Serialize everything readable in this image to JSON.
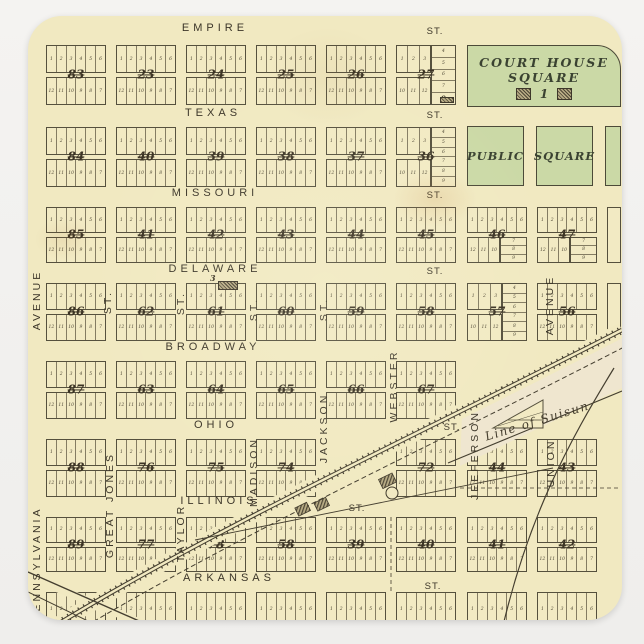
{
  "page": {
    "background": "#f1f0ee"
  },
  "map": {
    "paper_color": "#f1e9c1",
    "ink_color": "#4b4334",
    "square_green": "#cbd9a6",
    "beyond_line_color": "#efe6cf"
  },
  "streets": {
    "horizontal": [
      {
        "name": "EMPIRE",
        "st": "ST."
      },
      {
        "name": "TEXAS",
        "st": "ST."
      },
      {
        "name": "MISSOURI",
        "st": "ST."
      },
      {
        "name": "DELAWARE",
        "st": "ST."
      },
      {
        "name": "BROADWAY",
        "st": ""
      },
      {
        "name": "OHIO",
        "st": "ST."
      },
      {
        "name": "ILLINOIS",
        "st": "ST."
      },
      {
        "name": "ARKANSAS",
        "st": "ST."
      }
    ],
    "vertical": [
      {
        "name": "PENNSYLVANIA"
      },
      {
        "name": "AVENUE"
      },
      {
        "name": "ST."
      },
      {
        "name": "GREAT JONES"
      },
      {
        "name": "ST."
      },
      {
        "name": "TAYLOR"
      },
      {
        "name": "ST."
      },
      {
        "name": "MADISON"
      },
      {
        "name": "ST."
      },
      {
        "name": "JACKSON"
      },
      {
        "name": "WEBSTER"
      },
      {
        "name": "JEEFERSON"
      },
      {
        "name": "AVENUE"
      },
      {
        "name": "UNION"
      }
    ]
  },
  "landmarks": {
    "court_house_square": {
      "line1": "COURT HOUSE",
      "line2": "SQUARE",
      "label": "1"
    },
    "public_square": {
      "left": "PUBLIC",
      "right": "SQUARE"
    },
    "boundary_label": "Line of Suisun",
    "block61_label": "3",
    "block27_label": "9"
  },
  "lots": {
    "top": [
      "1",
      "2",
      "3",
      "4",
      "5",
      "6"
    ],
    "bottom": [
      "12",
      "11",
      "10",
      "9",
      "8",
      "7"
    ],
    "left_top": [
      "1",
      "2",
      "3"
    ],
    "left_bottom": [
      "10",
      "11",
      "12"
    ],
    "stack": [
      "4",
      "5",
      "6",
      "7",
      "8",
      "9"
    ],
    "stack9": [
      "4",
      "5",
      "6",
      "7",
      "9"
    ],
    "br_left": [
      "12",
      "11",
      "10"
    ],
    "br_stack": [
      "7",
      "8",
      "9"
    ],
    "tri": [
      "7",
      "8",
      "9"
    ]
  },
  "blocks": {
    "rows": [
      [
        {
          "c": 0,
          "n": "83"
        },
        {
          "c": 1,
          "n": "23"
        },
        {
          "c": 2,
          "n": "24"
        },
        {
          "c": 3,
          "n": "25"
        },
        {
          "c": 4,
          "n": "26"
        },
        {
          "c": 5,
          "n": "27",
          "v": "stack9"
        }
      ],
      [
        {
          "c": 0,
          "n": "84"
        },
        {
          "c": 1,
          "n": "40"
        },
        {
          "c": 2,
          "n": "39"
        },
        {
          "c": 3,
          "n": "38"
        },
        {
          "c": 4,
          "n": "37"
        },
        {
          "c": 5,
          "n": "36",
          "v": "stack"
        }
      ],
      [
        {
          "c": 0,
          "n": "85"
        },
        {
          "c": 1,
          "n": "41"
        },
        {
          "c": 2,
          "n": "42"
        },
        {
          "c": 3,
          "n": "43"
        },
        {
          "c": 4,
          "n": "44"
        },
        {
          "c": 5,
          "n": "45"
        },
        {
          "c": 6,
          "n": "46",
          "v": "stackbr"
        },
        {
          "c": 7,
          "n": "47",
          "v": "stackbr"
        },
        {
          "c": 8,
          "n": "",
          "v": "sliver"
        }
      ],
      [
        {
          "c": 0,
          "n": "86"
        },
        {
          "c": 1,
          "n": "62"
        },
        {
          "c": 2,
          "n": "61",
          "v": "bldg3"
        },
        {
          "c": 3,
          "n": "60"
        },
        {
          "c": 4,
          "n": "59"
        },
        {
          "c": 5,
          "n": "58"
        },
        {
          "c": 6,
          "n": "57",
          "v": "stack"
        },
        {
          "c": 7,
          "n": "56"
        },
        {
          "c": 8,
          "n": "",
          "v": "sliver"
        }
      ],
      [
        {
          "c": 0,
          "n": "87"
        },
        {
          "c": 1,
          "n": "63"
        },
        {
          "c": 2,
          "n": "64"
        },
        {
          "c": 3,
          "n": "65"
        },
        {
          "c": 4,
          "n": "66"
        },
        {
          "c": 5,
          "n": "67"
        }
      ],
      [
        {
          "c": 0,
          "n": "88"
        },
        {
          "c": 1,
          "n": "76"
        },
        {
          "c": 2,
          "n": "75"
        },
        {
          "c": 3,
          "n": "74"
        },
        {
          "c": 5,
          "n": "72"
        },
        {
          "c": 6,
          "n": "44"
        },
        {
          "c": 7,
          "n": "43"
        }
      ],
      [
        {
          "c": 0,
          "n": "89"
        },
        {
          "c": 1,
          "n": "77"
        },
        {
          "c": 2,
          "n": "78"
        },
        {
          "c": 3,
          "n": "58"
        },
        {
          "c": 4,
          "n": "39"
        },
        {
          "c": 5,
          "n": "40"
        },
        {
          "c": 6,
          "n": "41"
        },
        {
          "c": 7,
          "n": "42"
        }
      ],
      [
        {
          "c": 0,
          "n": "",
          "v": "partial"
        },
        {
          "c": 1,
          "n": "",
          "v": "partial"
        },
        {
          "c": 2,
          "n": "",
          "v": "partial"
        },
        {
          "c": 3,
          "n": "",
          "v": "partial"
        },
        {
          "c": 4,
          "n": "",
          "v": "partial"
        },
        {
          "c": 5,
          "n": "",
          "v": "partial"
        },
        {
          "c": 6,
          "n": "",
          "v": "partial"
        },
        {
          "c": 7,
          "n": "",
          "v": "partial"
        }
      ]
    ]
  }
}
